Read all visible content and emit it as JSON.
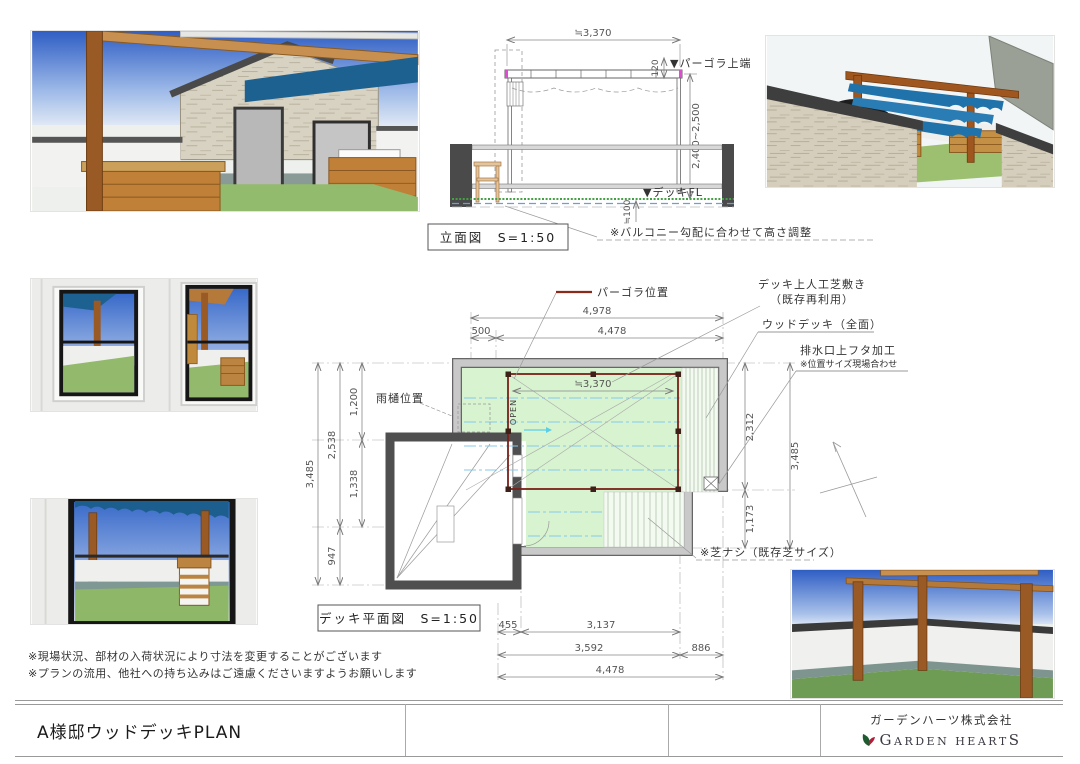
{
  "title_block": {
    "project_title": "A様邸ウッドデッキPLAN",
    "company_name": "ガーデンハーツ株式会社",
    "logo": {
      "g": "G",
      "arden": "ARDEN",
      "heart": "HEART",
      "s": "S"
    }
  },
  "notes": {
    "line1": "※現場状況、部材の入荷状況により寸法を変更することがございます",
    "line2": "※プランの流用、他社への持ち込みはご遠慮くださいますようお願いします"
  },
  "elevation": {
    "label": "立面図　S=1:50",
    "note": "※バルコニー勾配に合わせて高さ調整",
    "marker_pergola_top": "▼パーゴラ上端",
    "marker_deck_fl": "▼デッキFL",
    "dim_width": "≒3,370",
    "dim_beam": "120",
    "dim_height": "2,400~2,500",
    "dim_deck": "≒100"
  },
  "plan": {
    "label": "デッキ平面図　S=1:50",
    "open_label": "OPEN",
    "callout_pergola": "パーゴラ位置",
    "callout_grass_1": "デッキ上人工芝敷き",
    "callout_grass_2": "（既存再利用）",
    "callout_deck": "ウッドデッキ（全面）",
    "callout_drain_1": "排水口上フタ加工",
    "callout_drain_2": "※位置サイズ現場合わせ",
    "callout_gutter": "雨樋位置",
    "callout_no_grass": "※芝ナシ（既存芝サイズ）",
    "dims": {
      "top_total": "4,978",
      "top_left": "500",
      "top_main": "4,478",
      "inner_width": "≒3,370",
      "left_total": "3,485",
      "left_a": "1,200",
      "left_b": "2,538",
      "left_c": "1,338",
      "left_d": "947",
      "right_a": "2,312",
      "right_b": "1,173",
      "right_total": "3,485",
      "bottom_a": "455",
      "bottom_b": "3,137",
      "bottom_c": "3,592",
      "bottom_d": "886",
      "bottom_total": "4,478"
    }
  },
  "colors": {
    "awning_blue": "#1d6191",
    "wood": "#9a5a26",
    "grass": "#8fb968",
    "plan_grass": "#d8f3d0",
    "pergola_line": "#7a2018",
    "logo_green": "#1e5c30",
    "logo_red": "#b01e3c"
  }
}
